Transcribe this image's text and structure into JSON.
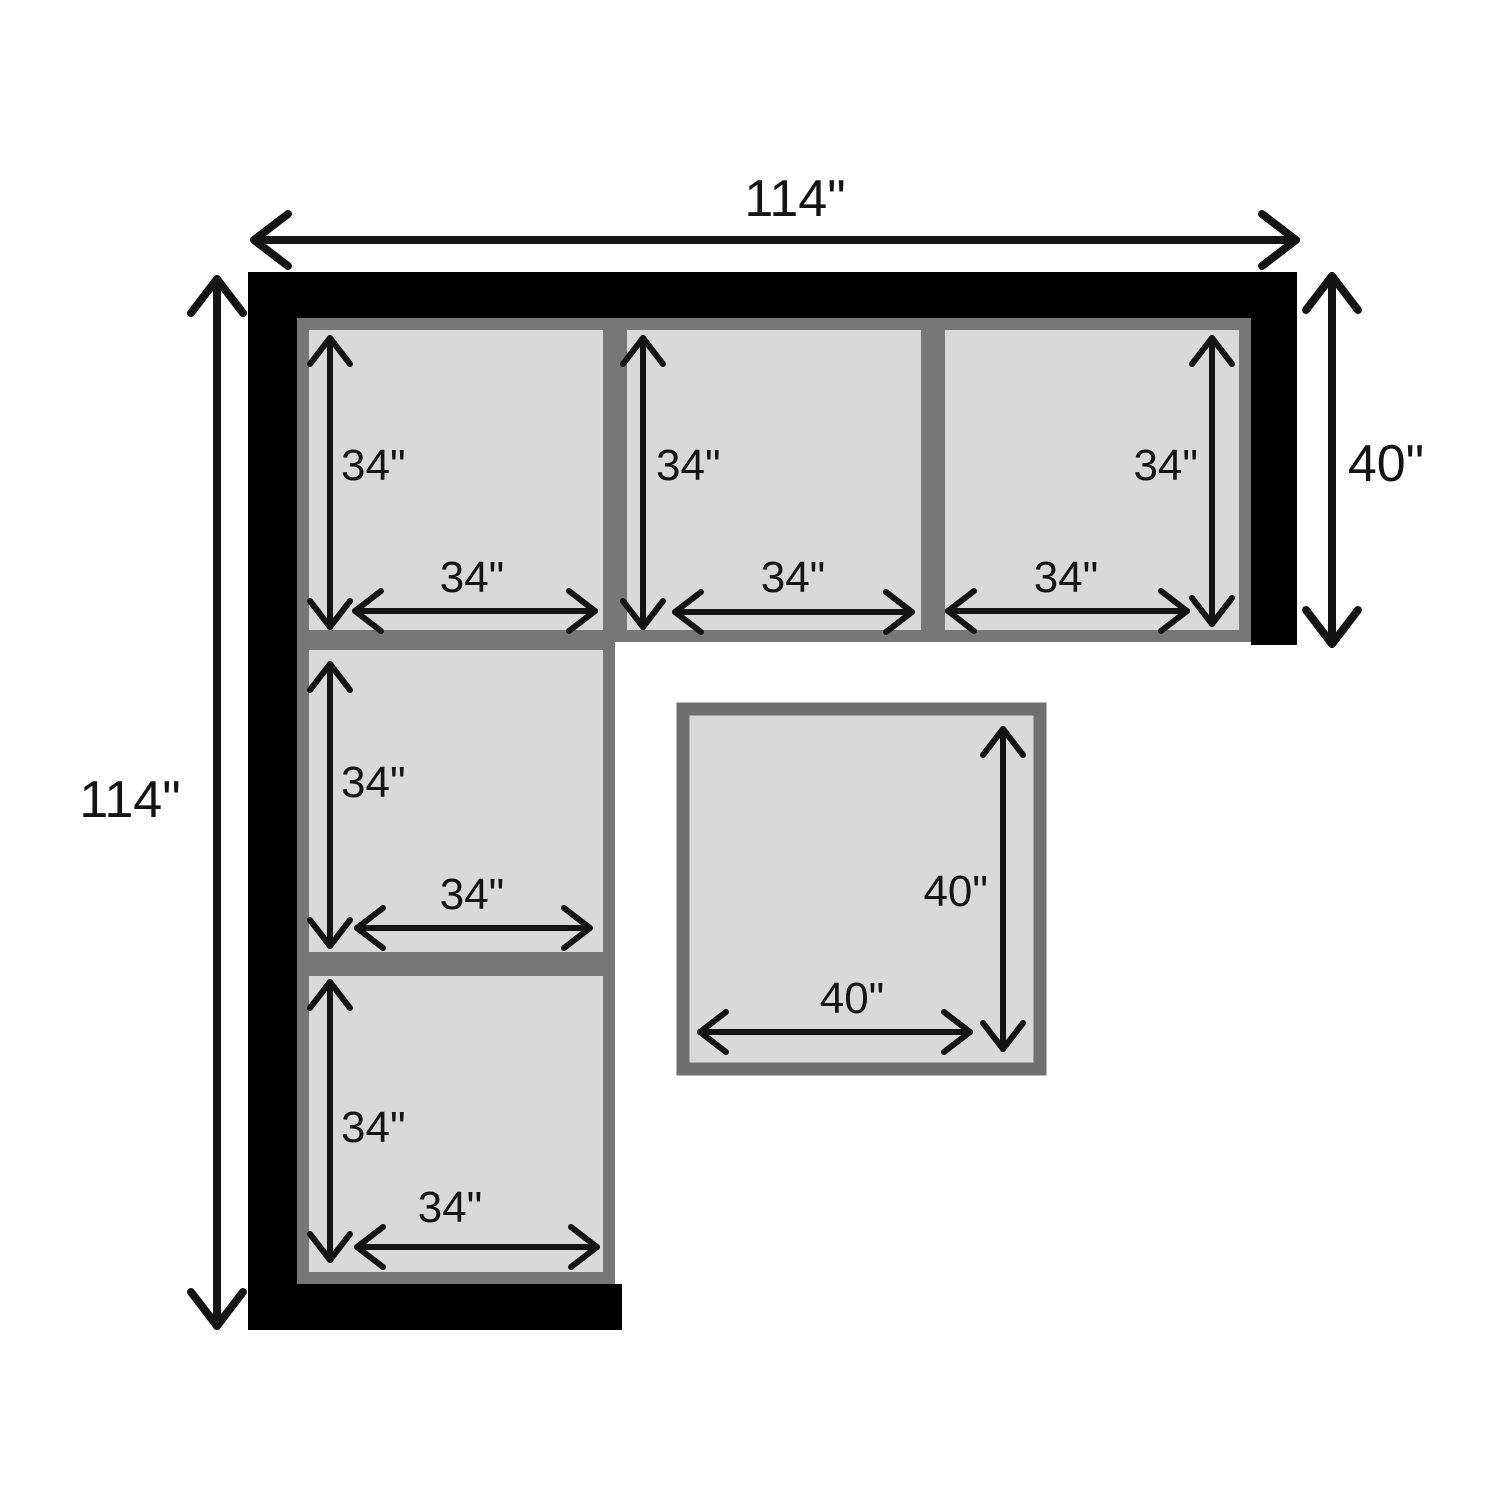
{
  "diagram": {
    "kind": "sectional-sofa-dimension-diagram",
    "overall": {
      "top_width": "114\"",
      "left_height": "114\"",
      "right_depth": "40\""
    },
    "cushions": [
      {
        "name": "top-left-seat",
        "height": "34\"",
        "width": "34\""
      },
      {
        "name": "top-middle-seat",
        "height": "34\"",
        "width": "34\""
      },
      {
        "name": "top-right-seat",
        "height": "34\"",
        "width": "34\""
      },
      {
        "name": "left-middle-seat",
        "height": "34\"",
        "width": "34\""
      },
      {
        "name": "left-bottom-seat",
        "height": "34\"",
        "width": "34\""
      },
      {
        "name": "ottoman",
        "height": "40\"",
        "width": "40\""
      }
    ],
    "colors": {
      "background": "#ffffff",
      "frame": "#000000",
      "cushion_fill": "#d9d9d9",
      "cushion_border": "#777777",
      "ottoman_border": "#707070",
      "dimension_ink": "#141414"
    }
  }
}
